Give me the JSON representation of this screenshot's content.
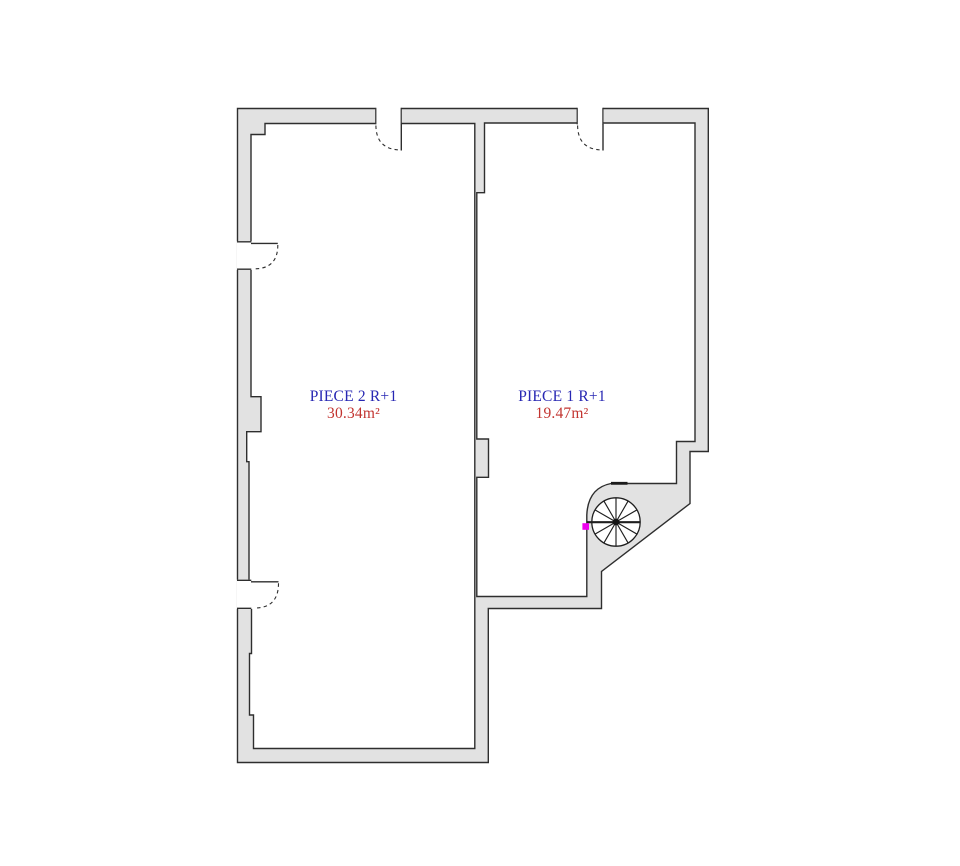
{
  "floorplan": {
    "rooms": [
      {
        "label": "PIECE 2 R+1",
        "area": "30.34m²"
      },
      {
        "label": "PIECE 1 R+1",
        "area": "19.47m²"
      }
    ],
    "symbols": {
      "door": "door-swing-icon",
      "staircase": "spiral-staircase-icon",
      "marker": "position-marker-dot"
    },
    "colors": {
      "wall_fill": "#e2e2e2",
      "wall_line": "#2e2e2e",
      "room_label_text": "#2727b3",
      "room_area_text": "#c23430",
      "marker": "#ee00ee",
      "background": "#ffffff"
    }
  }
}
